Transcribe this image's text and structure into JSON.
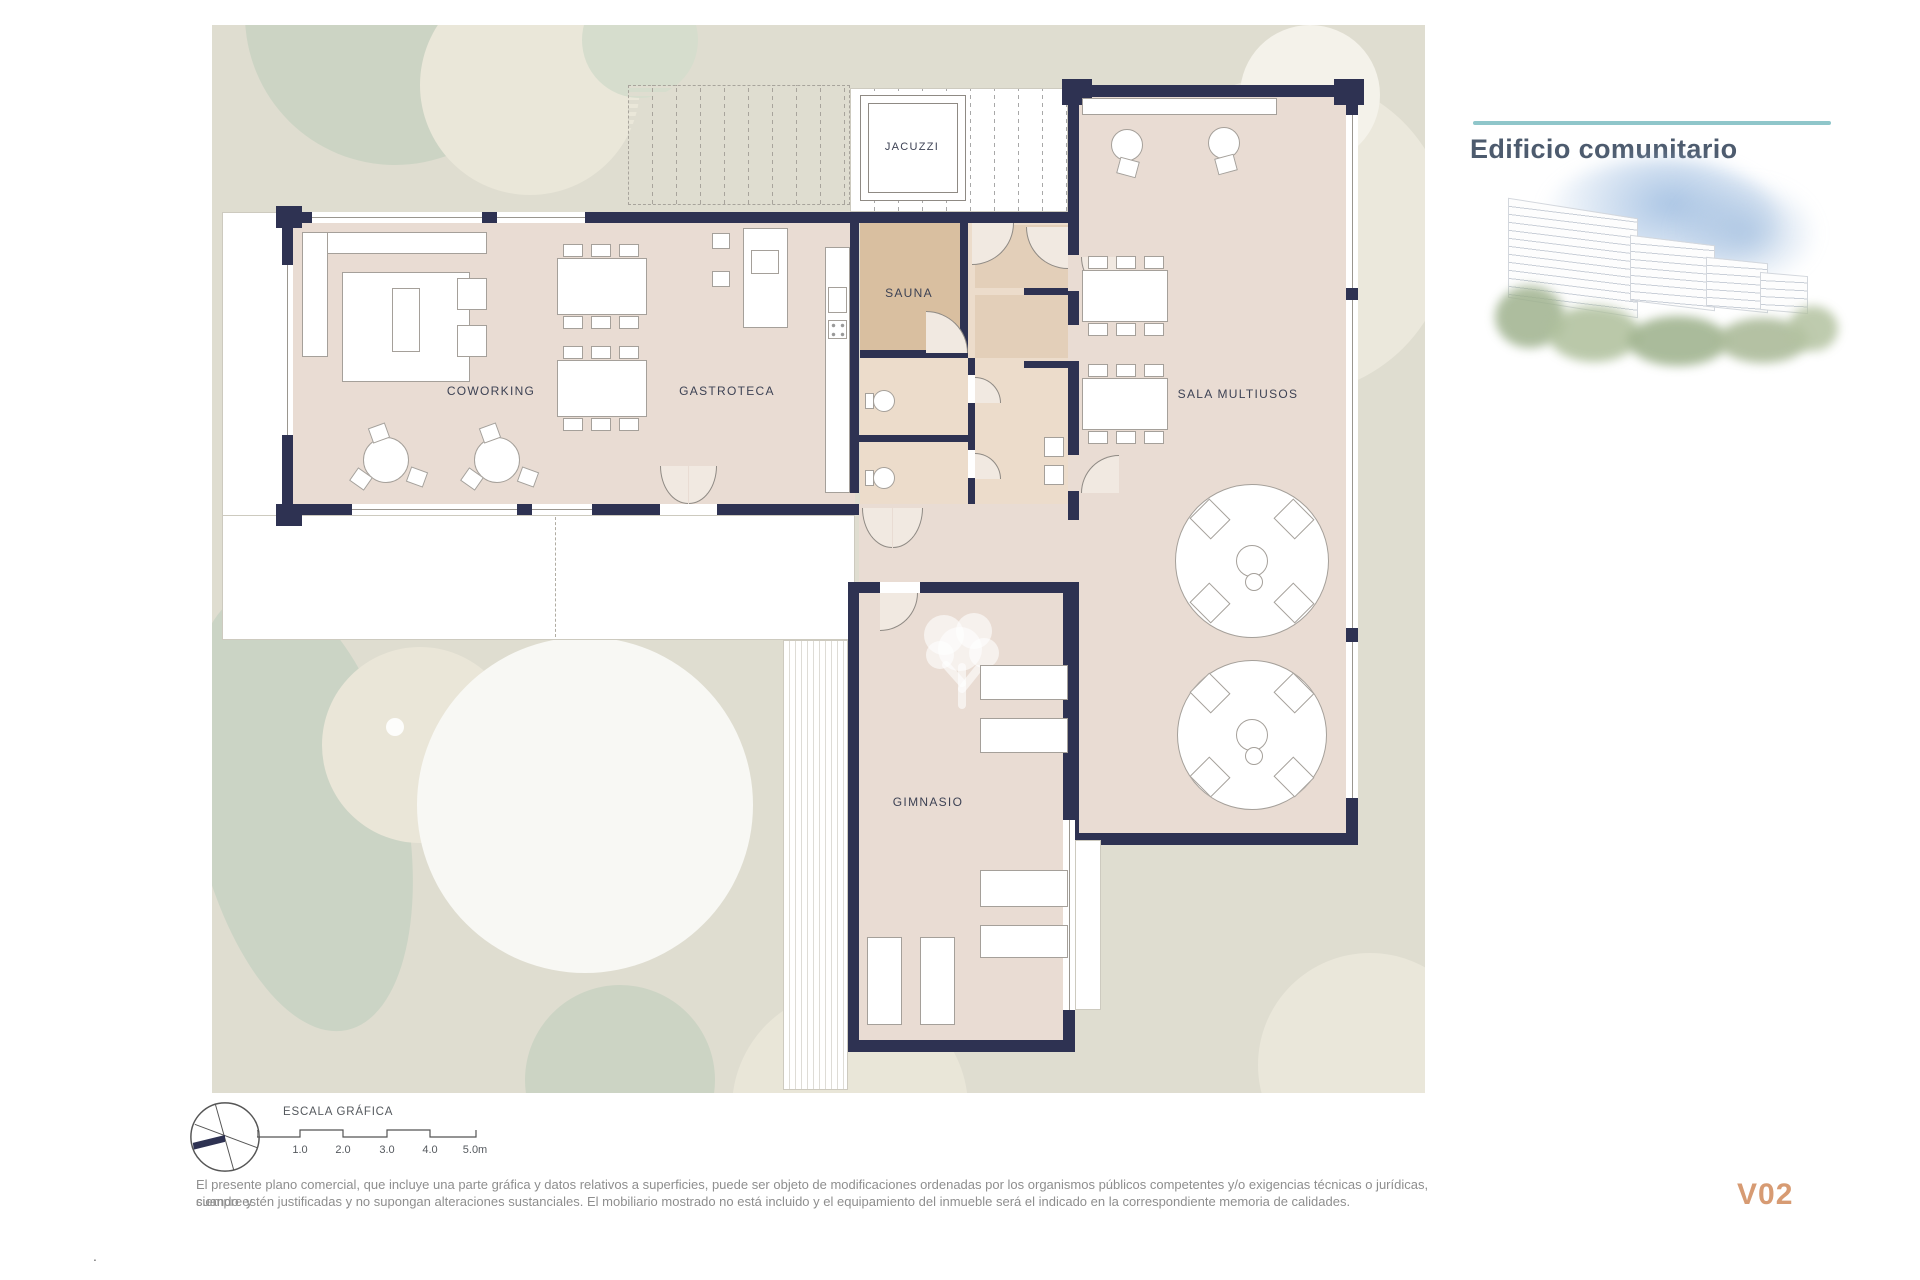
{
  "header": {
    "title": "Edificio comunitario",
    "version_label": "V02"
  },
  "plan": {
    "room_labels": {
      "jacuzzi": "JACUZZI",
      "sauna": "SAUNA",
      "coworking": "COWORKING",
      "gastroteca": "GASTROTECA",
      "sala_multiusos": "SALA MULTIUSOS",
      "gimnasio": "GIMNASIO"
    }
  },
  "scale_bar": {
    "title": "ESCALA GRÁFICA",
    "tick_labels": [
      "1.0",
      "2.0",
      "3.0",
      "4.0",
      "5.0m"
    ]
  },
  "footer": {
    "disclaimer_line1": "El presente plano comercial, que incluye una parte gráfica y datos relativos a superficies, puede ser objeto de modificaciones ordenadas por los organismos públicos competentes y/o exigencias técnicas o jurídicas, siempre y",
    "disclaimer_line2": "cuando estén justificadas y no supongan alteraciones sustanciales. El mobiliario mostrado no está incluido y el equipamiento del inmueble será el indicado en la correspondiente memoria de calidades.",
    "corner_mark": "."
  },
  "colors": {
    "wall": "#2e3252",
    "room_fill": "#e9dcd3",
    "sauna_fill": "#d9bfa0",
    "landscape": "#dfddd0",
    "accent_teal": "#8fc6ca",
    "version_color": "#d79b73"
  }
}
